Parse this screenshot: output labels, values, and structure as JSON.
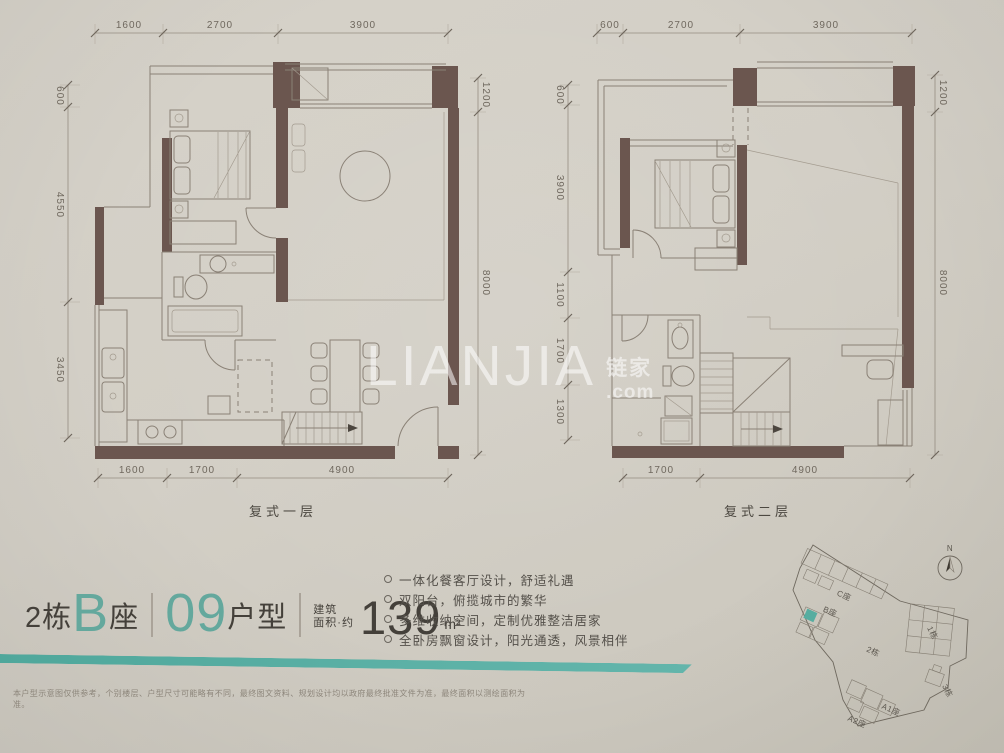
{
  "page": {
    "watermark": {
      "logo": "LIANJIA",
      "cn": "链家",
      "domain": ".com"
    },
    "disclaimer": "本户型示意图仅供参考，个别楼层、户型尺寸可能略有不同，最终图文资料、规划设计均以政府最终批准文件为准，最终面积以测绘面积为准。"
  },
  "plan_first": {
    "label": "复式一层",
    "dims_top": [
      "1600",
      "2700",
      "3900"
    ],
    "dims_left": [
      "600",
      "4550",
      "3450"
    ],
    "dims_right": [
      "1200",
      "8000"
    ],
    "dims_bottom": [
      "1600",
      "1700",
      "4900"
    ]
  },
  "plan_second": {
    "label": "复式二层",
    "dims_top": [
      "600",
      "2700",
      "3900"
    ],
    "dims_left": [
      "600",
      "3900",
      "1100",
      "1700",
      "1300"
    ],
    "dims_right": [
      "1200",
      "8000"
    ],
    "dims_bottom": [
      "1700",
      "4900"
    ]
  },
  "title": {
    "building": "2栋",
    "block_letter": "B",
    "block_suffix": "座",
    "unit_number": "09",
    "unit_suffix": "户型",
    "area_label_line1": "建筑",
    "area_label_line2": "面积·约",
    "area_value": "139",
    "area_unit": "m²"
  },
  "features": {
    "items": [
      "一体化餐客厅设计，舒适礼遇",
      "双阳台，俯揽城市的繁华",
      "多维收纳空间，定制优雅整洁居家",
      "全卧房飘窗设计，阳光通透，风景相伴"
    ]
  },
  "site_plan": {
    "labels": {
      "c": "C座",
      "b": "B座",
      "b1": "1栋",
      "b2": "2栋",
      "a1": "A1座",
      "a2": "A2座",
      "b3": "3栋"
    },
    "compass": "N",
    "highlight_color": "#57ada0"
  },
  "colors": {
    "wall": "#6b564f",
    "teal": "#57ada0",
    "background": "#d3cfc6"
  }
}
